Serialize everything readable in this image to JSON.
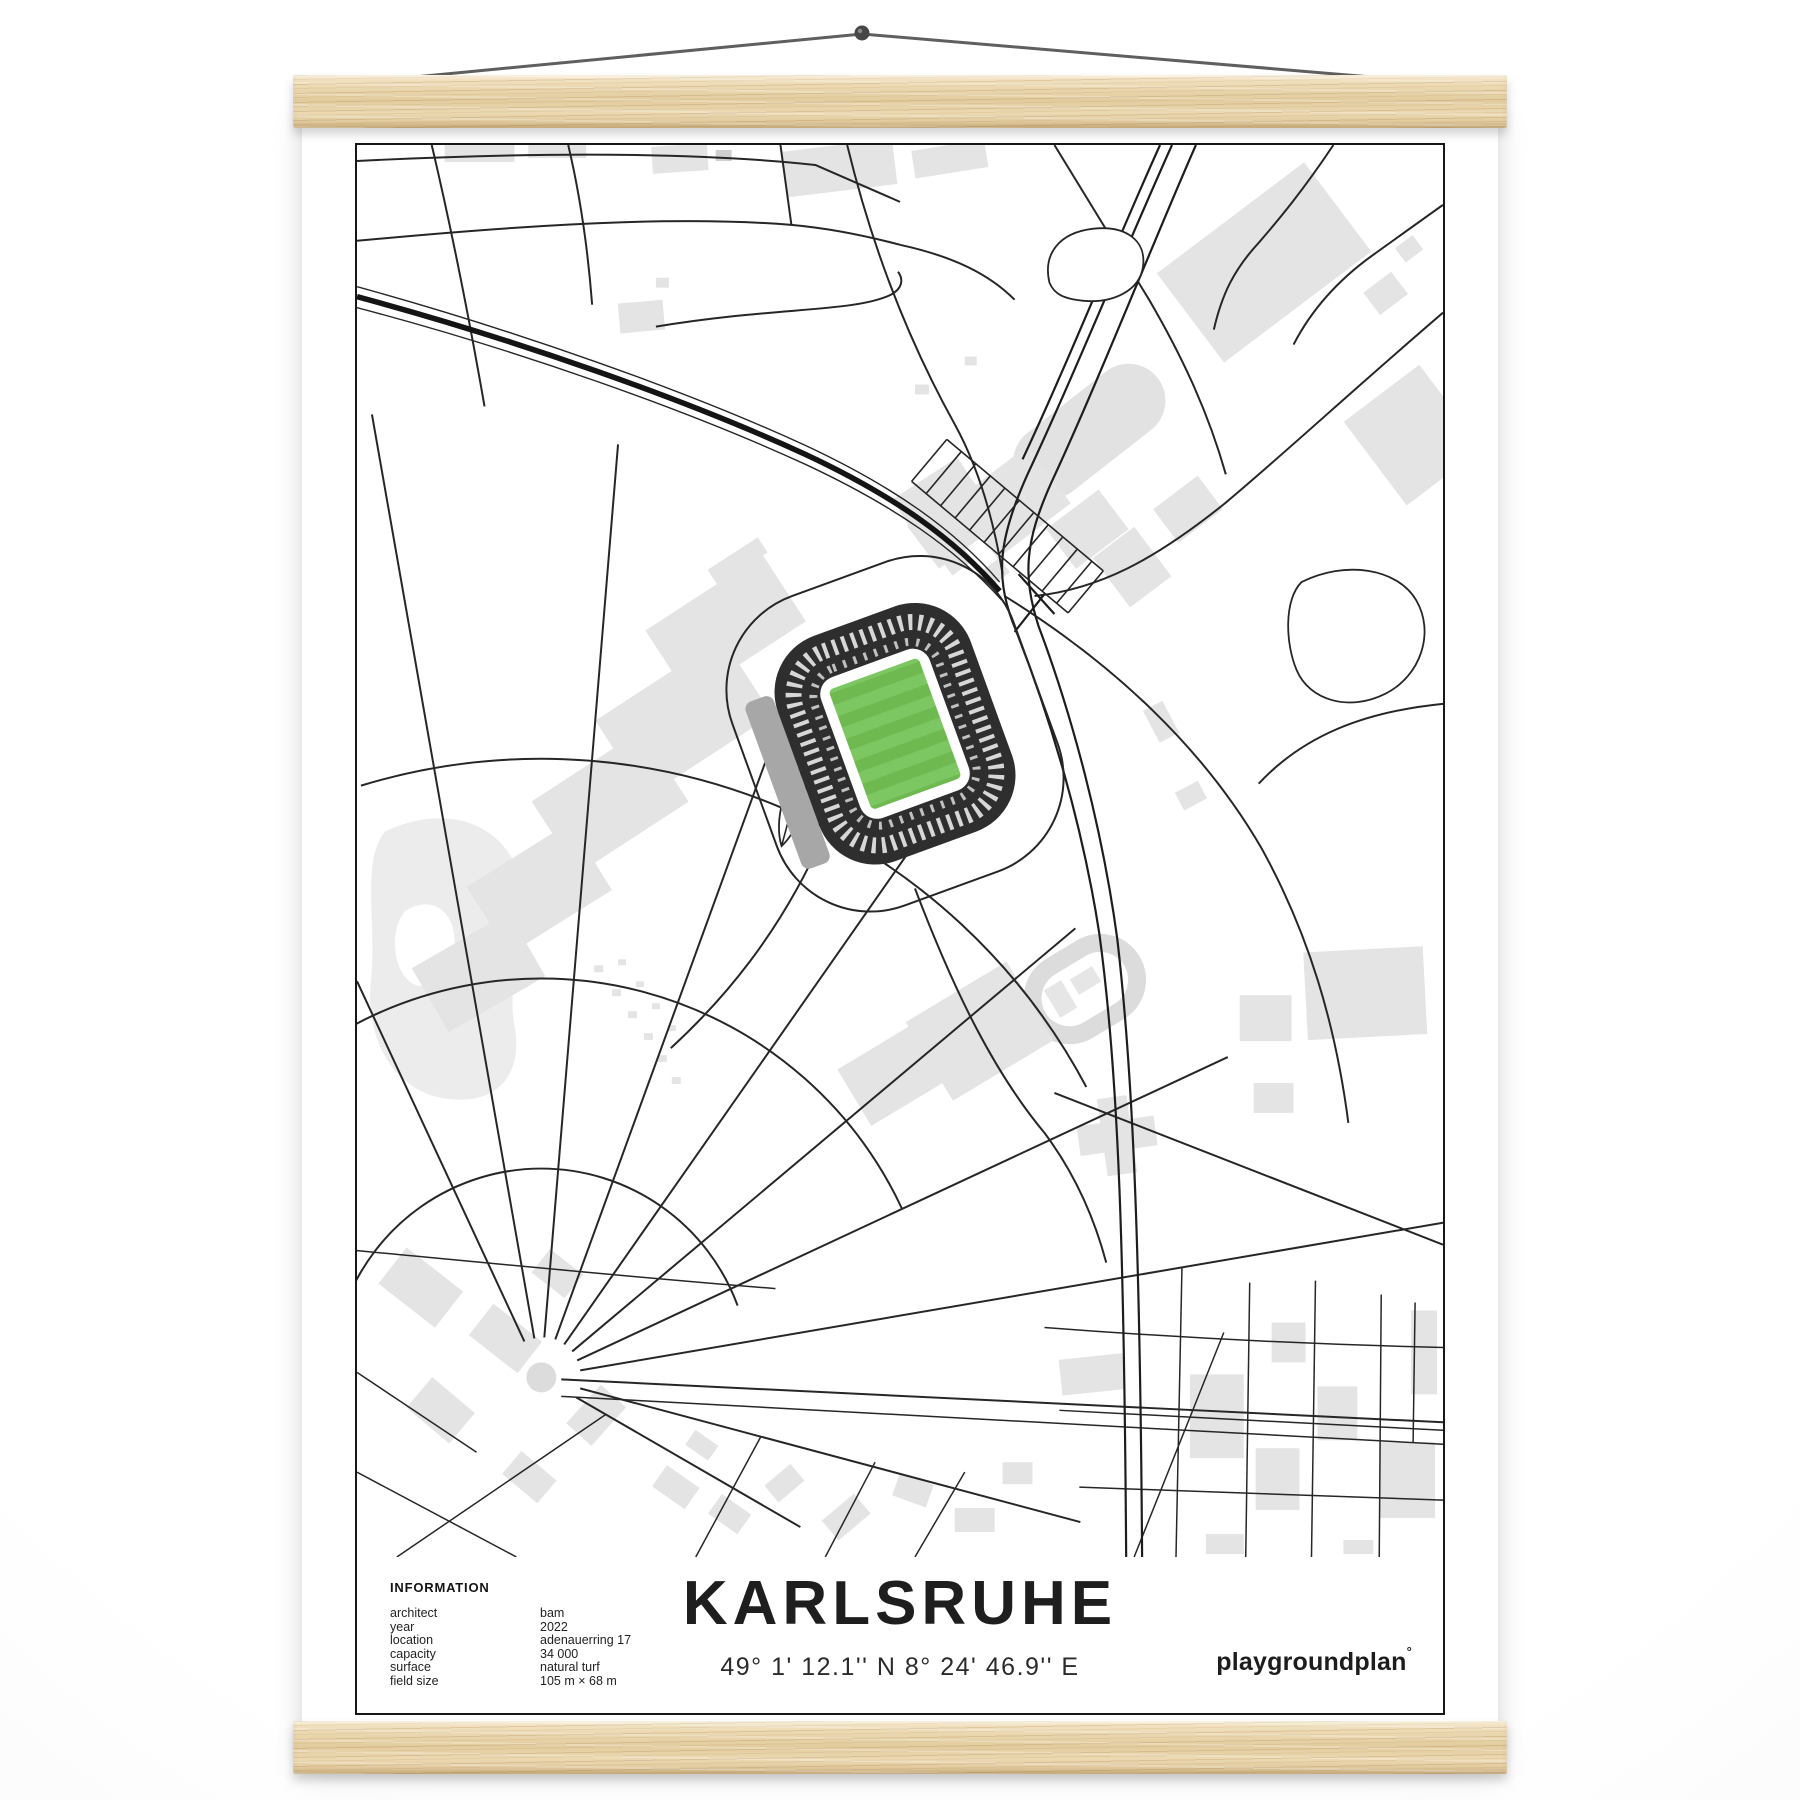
{
  "poster": {
    "title": "KARLSRUHE",
    "coordinates": "49° 1' 12.1'' N  8° 24' 46.9'' E",
    "brand": "playgroundplan",
    "brand_mark": "°",
    "info": {
      "heading": "INFORMATION",
      "rows": [
        {
          "label": "architect",
          "value": "bam"
        },
        {
          "label": "year",
          "value": "2022"
        },
        {
          "label": "location",
          "value": "adenauerring 17"
        },
        {
          "label": "capacity",
          "value": "34 000"
        },
        {
          "label": "surface",
          "value": "natural turf"
        },
        {
          "label": "field size",
          "value": "105 m × 68 m"
        }
      ]
    }
  },
  "colors": {
    "pitch_a": "#7dc763",
    "pitch_b": "#6eba51",
    "stand": "#2e2e2e",
    "roof": "#a7a7a7",
    "building": "#e4e4e4",
    "road": "#262626",
    "rail_track": "#1d1d1d",
    "frame": "#171717",
    "wood_light": "#f4e7c9",
    "wood_mid": "#ecd9b2",
    "wood_dark": "#d9bf8f",
    "string": "#5f5f5f",
    "paper": "#ffffff"
  }
}
